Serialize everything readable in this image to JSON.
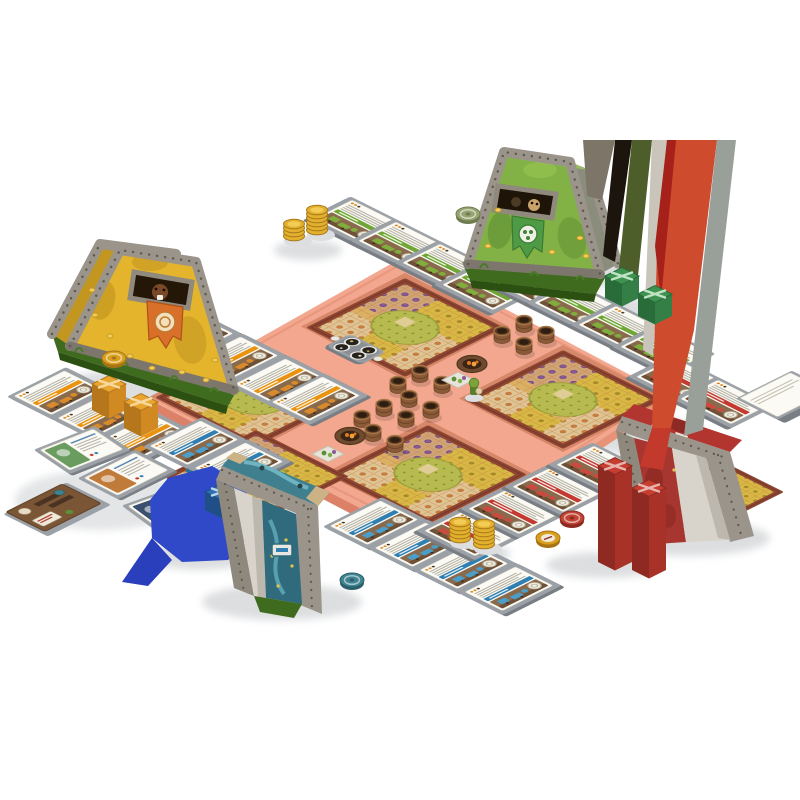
{
  "scene": {
    "kind": "isometric-board-game-setup",
    "background": "#ffffff"
  },
  "palette": {
    "bg": "#ffffff",
    "shadow": "#dcdee0",
    "stone": "#9a948a",
    "stone-dark": "#7d766c",
    "rivet": "#5f584e",
    "slab": "#3e6b1d",
    "slab-dark": "#2c4f12",
    "base": "#f2a78e",
    "base-side": "#dd8068",
    "farm-border": "#8e4531",
    "tent-yellow": "#e3b42c",
    "tent-yellow-shade": "#c2961f",
    "tent-green": "#82b245",
    "tent-green-shade": "#8a8d7c",
    "tent-teal": "#3f7f8e",
    "tent-teal-deep": "#2f6b7c",
    "tent-red": "#b23530",
    "tent-red-deep": "#a83630",
    "canvas-inner": "#d8d4cc",
    "canvas-inner-shade": "#bdb8ae",
    "flag-orange": "#d8702a",
    "flag-green": "#4f9a44",
    "card-white": "#fbfaf5",
    "mat-top": "#9ba1a6",
    "mat-side": "#787e83",
    "coin": "#e2b02c",
    "coin-light": "#f2cc56",
    "gold-deep": "#a8791c"
  },
  "players": {
    "yellow": {
      "banner": "#e9930f",
      "art": "#d98a2a"
    },
    "green": {
      "banner": "#6fa634",
      "art": "#7fae3c"
    },
    "blue": {
      "banner": "#2f7fb2",
      "art": "#4a9ec9"
    },
    "red": {
      "banner": "#c43a30",
      "art": "#c94a3e"
    }
  },
  "cards": [
    {
      "player": "yellow",
      "variant": "A",
      "x": 100,
      "y": 318
    },
    {
      "player": "yellow",
      "variant": "A",
      "x": 145,
      "y": 340
    },
    {
      "player": "yellow",
      "variant": "A",
      "x": 190,
      "y": 362
    },
    {
      "player": "yellow",
      "variant": "A",
      "x": 235,
      "y": 384
    },
    {
      "player": "yellow",
      "variant": "A",
      "x": 272,
      "y": 402
    },
    {
      "player": "yellow",
      "variant": "A",
      "x": 14,
      "y": 396
    },
    {
      "player": "yellow",
      "variant": "A",
      "x": 58,
      "y": 418
    },
    {
      "player": "yellow",
      "variant": "A",
      "x": 102,
      "y": 440
    },
    {
      "player": "green",
      "variant": "B",
      "x": 352,
      "y": 200
    },
    {
      "player": "green",
      "variant": "B",
      "x": 396,
      "y": 222
    },
    {
      "player": "green",
      "variant": "B",
      "x": 440,
      "y": 244
    },
    {
      "player": "green",
      "variant": "B",
      "x": 480,
      "y": 266
    },
    {
      "player": "green",
      "variant": "B",
      "x": 528,
      "y": 262
    },
    {
      "player": "green",
      "variant": "B",
      "x": 572,
      "y": 284
    },
    {
      "player": "green",
      "variant": "B",
      "x": 616,
      "y": 306
    },
    {
      "player": "green",
      "variant": "B",
      "x": 658,
      "y": 328
    },
    {
      "player": "blue",
      "variant": "A",
      "x": 150,
      "y": 446
    },
    {
      "player": "blue",
      "variant": "A",
      "x": 195,
      "y": 468
    },
    {
      "player": "blue",
      "variant": "A",
      "x": 330,
      "y": 526
    },
    {
      "player": "blue",
      "variant": "A",
      "x": 375,
      "y": 548
    },
    {
      "player": "blue",
      "variant": "A",
      "x": 420,
      "y": 570
    },
    {
      "player": "blue",
      "variant": "A",
      "x": 465,
      "y": 592
    },
    {
      "player": "red",
      "variant": "B",
      "x": 462,
      "y": 512
    },
    {
      "player": "red",
      "variant": "B",
      "x": 506,
      "y": 490
    },
    {
      "player": "red",
      "variant": "B",
      "x": 550,
      "y": 468
    },
    {
      "player": "red",
      "variant": "B",
      "x": 594,
      "y": 446
    },
    {
      "player": "red",
      "variant": "B",
      "x": 674,
      "y": 358
    },
    {
      "player": "red",
      "variant": "B",
      "x": 718,
      "y": 380
    }
  ],
  "deck_piles": [
    {
      "x": 740,
      "y": 398
    }
  ],
  "objective_cards": [
    {
      "x": 40,
      "y": 450,
      "m": [
        0.76,
        -0.3,
        0.62,
        0.42
      ],
      "art": "#6a9c5f"
    },
    {
      "x": 84,
      "y": 478,
      "m": [
        0.72,
        -0.36,
        0.7,
        0.36
      ],
      "art": "#c07a3a"
    },
    {
      "x": 128,
      "y": 506,
      "m": [
        0.78,
        -0.28,
        0.6,
        0.44
      ],
      "art": "#39506e"
    }
  ],
  "bundles": [
    {
      "color": "orange",
      "x": 92,
      "y": 384,
      "h": 26,
      "stage": "pre"
    },
    {
      "color": "orange",
      "x": 124,
      "y": 402,
      "h": 26,
      "stage": "pre"
    },
    {
      "color": "blue",
      "x": 205,
      "y": 492,
      "h": 18,
      "stage": "pre"
    },
    {
      "color": "blue",
      "x": 237,
      "y": 510,
      "h": 16,
      "stage": "pre"
    },
    {
      "color": "green",
      "x": 605,
      "y": 276,
      "h": 22,
      "stage": "post"
    },
    {
      "color": "green",
      "x": 638,
      "y": 294,
      "h": 22,
      "stage": "post"
    },
    {
      "color": "red",
      "x": 598,
      "y": 466,
      "h": 96,
      "stage": "post"
    },
    {
      "color": "red",
      "x": 632,
      "y": 488,
      "h": 82,
      "stage": "post"
    }
  ],
  "bundle_colors": {
    "orange": {
      "t": "#e8a62e",
      "l": "#b5761c",
      "r": "#d18a22",
      "x": "#f7d9a0"
    },
    "green": {
      "t": "#3f9350",
      "l": "#2a6b3a",
      "r": "#347f45",
      "x": "#bfe3c4"
    },
    "blue": {
      "t": "#2f6fb2",
      "l": "#1f4f86",
      "r": "#285f9c",
      "x": "#bcd8ef"
    },
    "red": {
      "t": "#c53e30",
      "l": "#8e2a22",
      "r": "#a83228",
      "x": "#e8b5ae"
    }
  },
  "coin_stacks": [
    {
      "x": 294,
      "y": 236,
      "n": 4
    },
    {
      "x": 317,
      "y": 230,
      "n": 6
    },
    {
      "x": 460,
      "y": 538,
      "n": 5
    },
    {
      "x": 484,
      "y": 544,
      "n": 6
    }
  ],
  "tokens": [
    {
      "kind": "gold-token",
      "x": 114,
      "y": 358,
      "top": "#d9a01f",
      "side": "#a87416"
    },
    {
      "kind": "green-token",
      "x": 468,
      "y": 214,
      "top": "#97a471",
      "side": "#6f7c50"
    },
    {
      "kind": "teal-token",
      "x": 352,
      "y": 580,
      "top": "#3f8391",
      "side": "#2a5f6b"
    },
    {
      "kind": "red-token",
      "x": 572,
      "y": 518,
      "top": "#c24434",
      "side": "#8e2a20"
    },
    {
      "kind": "compass-token",
      "x": 548,
      "y": 538,
      "top": "#d9a01f",
      "side": "#a87416"
    }
  ],
  "baskets": [
    [
      502,
      340
    ],
    [
      524,
      329
    ],
    [
      524,
      351
    ],
    [
      546,
      340
    ],
    [
      398,
      390
    ],
    [
      420,
      379
    ],
    [
      442,
      390
    ],
    [
      409,
      404
    ],
    [
      431,
      415
    ],
    [
      362,
      424
    ],
    [
      384,
      413
    ],
    [
      406,
      424
    ],
    [
      373,
      438
    ],
    [
      395,
      449
    ]
  ],
  "firepits": [
    [
      472,
      364
    ],
    [
      350,
      436
    ]
  ],
  "veg_plates": [
    [
      442,
      380
    ],
    [
      312,
      454
    ]
  ],
  "machines": [
    {
      "color": "blue",
      "x": 212,
      "y": 444
    },
    {
      "color": "blue",
      "x": 244,
      "y": 458
    },
    {
      "color": "blue",
      "x": 186,
      "y": 466
    },
    {
      "color": "blue",
      "x": 182,
      "y": 498
    },
    {
      "color": "blue",
      "x": 214,
      "y": 512
    },
    {
      "color": "blue",
      "x": 246,
      "y": 526
    },
    {
      "color": "red",
      "x": 664,
      "y": 470
    },
    {
      "color": "red",
      "x": 696,
      "y": 484
    },
    {
      "color": "red",
      "x": 728,
      "y": 498
    },
    {
      "color": "red",
      "x": 682,
      "y": 512
    },
    {
      "color": "red",
      "x": 714,
      "y": 524
    }
  ],
  "machine_colors": {
    "blue": {
      "t": "#4a9ec9",
      "s": "#2e6f96"
    },
    "red": {
      "t": "#c94a3e",
      "s": "#942e26"
    }
  },
  "glitch_streaks": [
    {
      "pts": "583,140 615,140 602,200 587,196",
      "c": "#7d7668"
    },
    {
      "pts": "615,140 632,140 615,262 603,256",
      "c": "#1b150e"
    },
    {
      "pts": "632,140 652,140 638,276 619,268",
      "c": "#4d5e2b"
    },
    {
      "pts": "652,140 667,140 653,356 643,350",
      "c": "#c9c5ba"
    },
    {
      "pts": "667,140 717,140 694,330 671,428 652,428 657,250",
      "c": "#cf4b2d"
    },
    {
      "pts": "667,140 676,140 661,300 655,246",
      "c": "#a7211b"
    },
    {
      "pts": "717,140 736,140 703,430 684,436",
      "c": "#99a099"
    },
    {
      "pts": "652,428 671,428 663,470 640,466",
      "c": "#c33a2c"
    }
  ],
  "blue_blob": {
    "body": "168,478 212,466 246,486 252,532 228,560 182,562 152,538 150,500",
    "tail": "152,538 122,582 148,586 172,560",
    "color": "#2f49c9",
    "tail_color": "#2a3fbb"
  }
}
